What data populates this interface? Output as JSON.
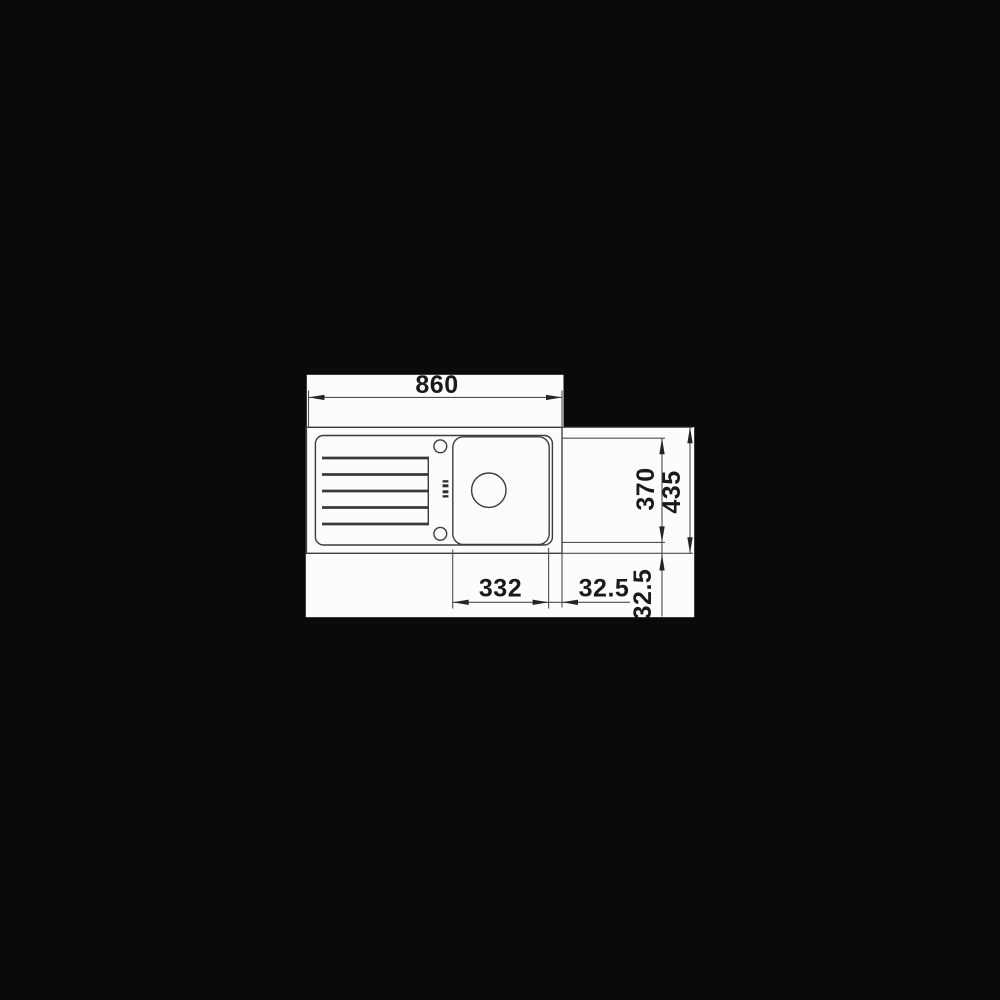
{
  "page": {
    "background_color": "#0a0a0a",
    "panel_color": "#fcfcfc",
    "line_color": "#3c3c3c",
    "text_color": "#1a1a1a"
  },
  "drawing": {
    "kind": "technical dimension drawing",
    "subject": "kitchen sink with drainboard and single bowl, top view"
  },
  "dims": {
    "overall_length": "860",
    "overall_width": "435",
    "inner_width": "370",
    "bowl_length": "332",
    "offset_right": "32.5",
    "offset_bottom": "32.5"
  }
}
